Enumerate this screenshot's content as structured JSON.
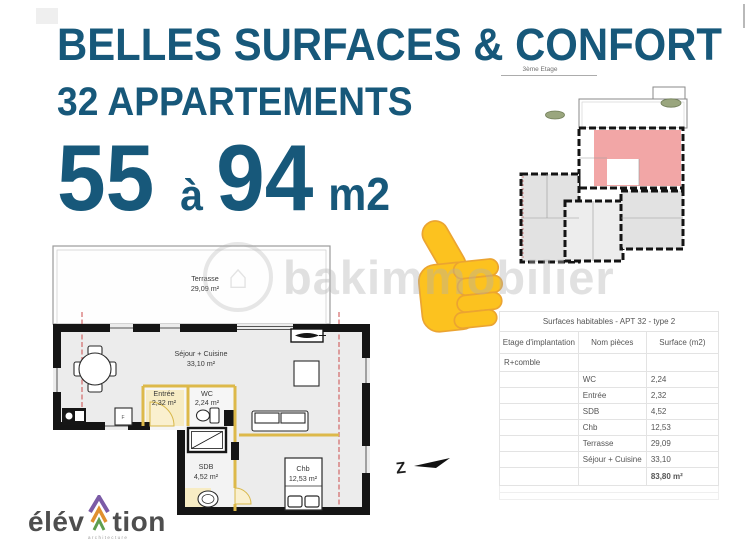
{
  "colors": {
    "accent": "#17587a",
    "plan_wall": "#151515",
    "plan_floor": "#ececec",
    "partition_yellow": "#ddb94a",
    "highlight_pink": "#f2a6a6",
    "section_red": "#cc4b4b",
    "emoji_yellow": "#fcc21f"
  },
  "headline": {
    "line1": "BELLES SURFACES & CONFORT",
    "line2": "32 APPARTEMENTS",
    "range_from": "55",
    "range_connector": "à",
    "range_to": "94",
    "range_unit": "m2"
  },
  "mini_plan": {
    "floor_label": "3ème Etage"
  },
  "floor_plan": {
    "terrace": {
      "name": "Terrasse",
      "area": "29,09 m²"
    },
    "living": {
      "name": "Séjour + Cuisine",
      "area": "33,10 m²"
    },
    "entry": {
      "name": "Entrée",
      "area": "2,32 m²"
    },
    "wc": {
      "name": "WC",
      "area": "2,24 m²"
    },
    "bathroom": {
      "name": "SDB",
      "area": "4,52 m²"
    },
    "bedroom": {
      "name": "Chb",
      "area": "12,53 m²"
    },
    "kitchen_mark": "F",
    "north_label": "Z"
  },
  "surface_table": {
    "title": "Surfaces habitables - APT 32 - type 2",
    "headers": [
      "Etage d'implantation",
      "Nom pièces",
      "Surface (m2)"
    ],
    "group_label": "R+comble",
    "rows": [
      {
        "room": "WC",
        "surface": "2,24"
      },
      {
        "room": "Entrée",
        "surface": "2,32"
      },
      {
        "room": "SDB",
        "surface": "4,52"
      },
      {
        "room": "Chb",
        "surface": "12,53"
      },
      {
        "room": "Terrasse",
        "surface": "29,09"
      },
      {
        "room": "Séjour + Cuisine",
        "surface": "33,10"
      }
    ],
    "total": "83,80 m²"
  },
  "watermark": {
    "text": "bakimmobilier"
  },
  "logo": {
    "prefix": "élév",
    "suffix": "tion",
    "tagline": "architecture"
  }
}
